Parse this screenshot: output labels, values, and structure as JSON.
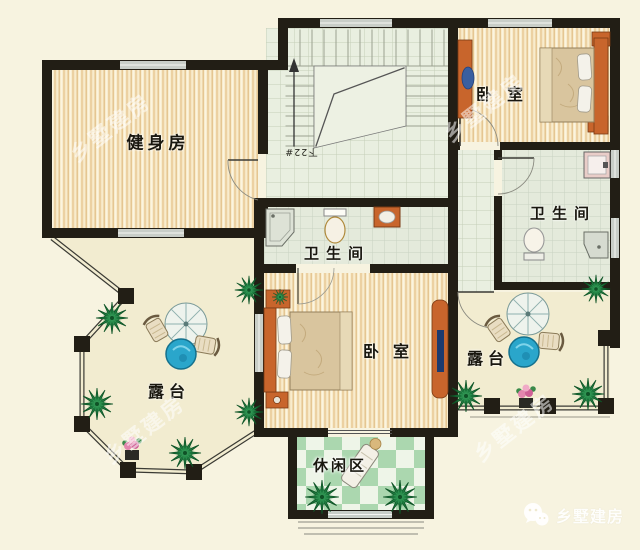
{
  "rooms": {
    "gym": {
      "label": "健身房"
    },
    "bedroom_top_right": {
      "label": "卧室"
    },
    "bathroom_right": {
      "label": "卫生间"
    },
    "bathroom_center": {
      "label": "卫生间"
    },
    "bedroom_center": {
      "label": "卧室"
    },
    "terrace_left": {
      "label": "露台"
    },
    "terrace_right": {
      "label": "露台"
    },
    "leisure_area": {
      "label": "休闲区"
    }
  },
  "stairs": {
    "annotation": "下22#"
  },
  "watermark": {
    "text": "乡墅建房"
  },
  "logo": {
    "text": "乡墅建房",
    "icon": "wechat-bubbles-icon"
  },
  "colors": {
    "background": "#f7f3e0",
    "wall": "#221e15",
    "wood_floor": "#f8eccd",
    "hall_tile": "#e9efe0",
    "bath_tile": "#e4eadb",
    "leisure_green": "#abd7af",
    "terrace_cream": "#f2ecd0",
    "furniture_orange": "#c8652c",
    "table_blue": "#2aa6cb",
    "plant_green": "#1e7c40"
  }
}
